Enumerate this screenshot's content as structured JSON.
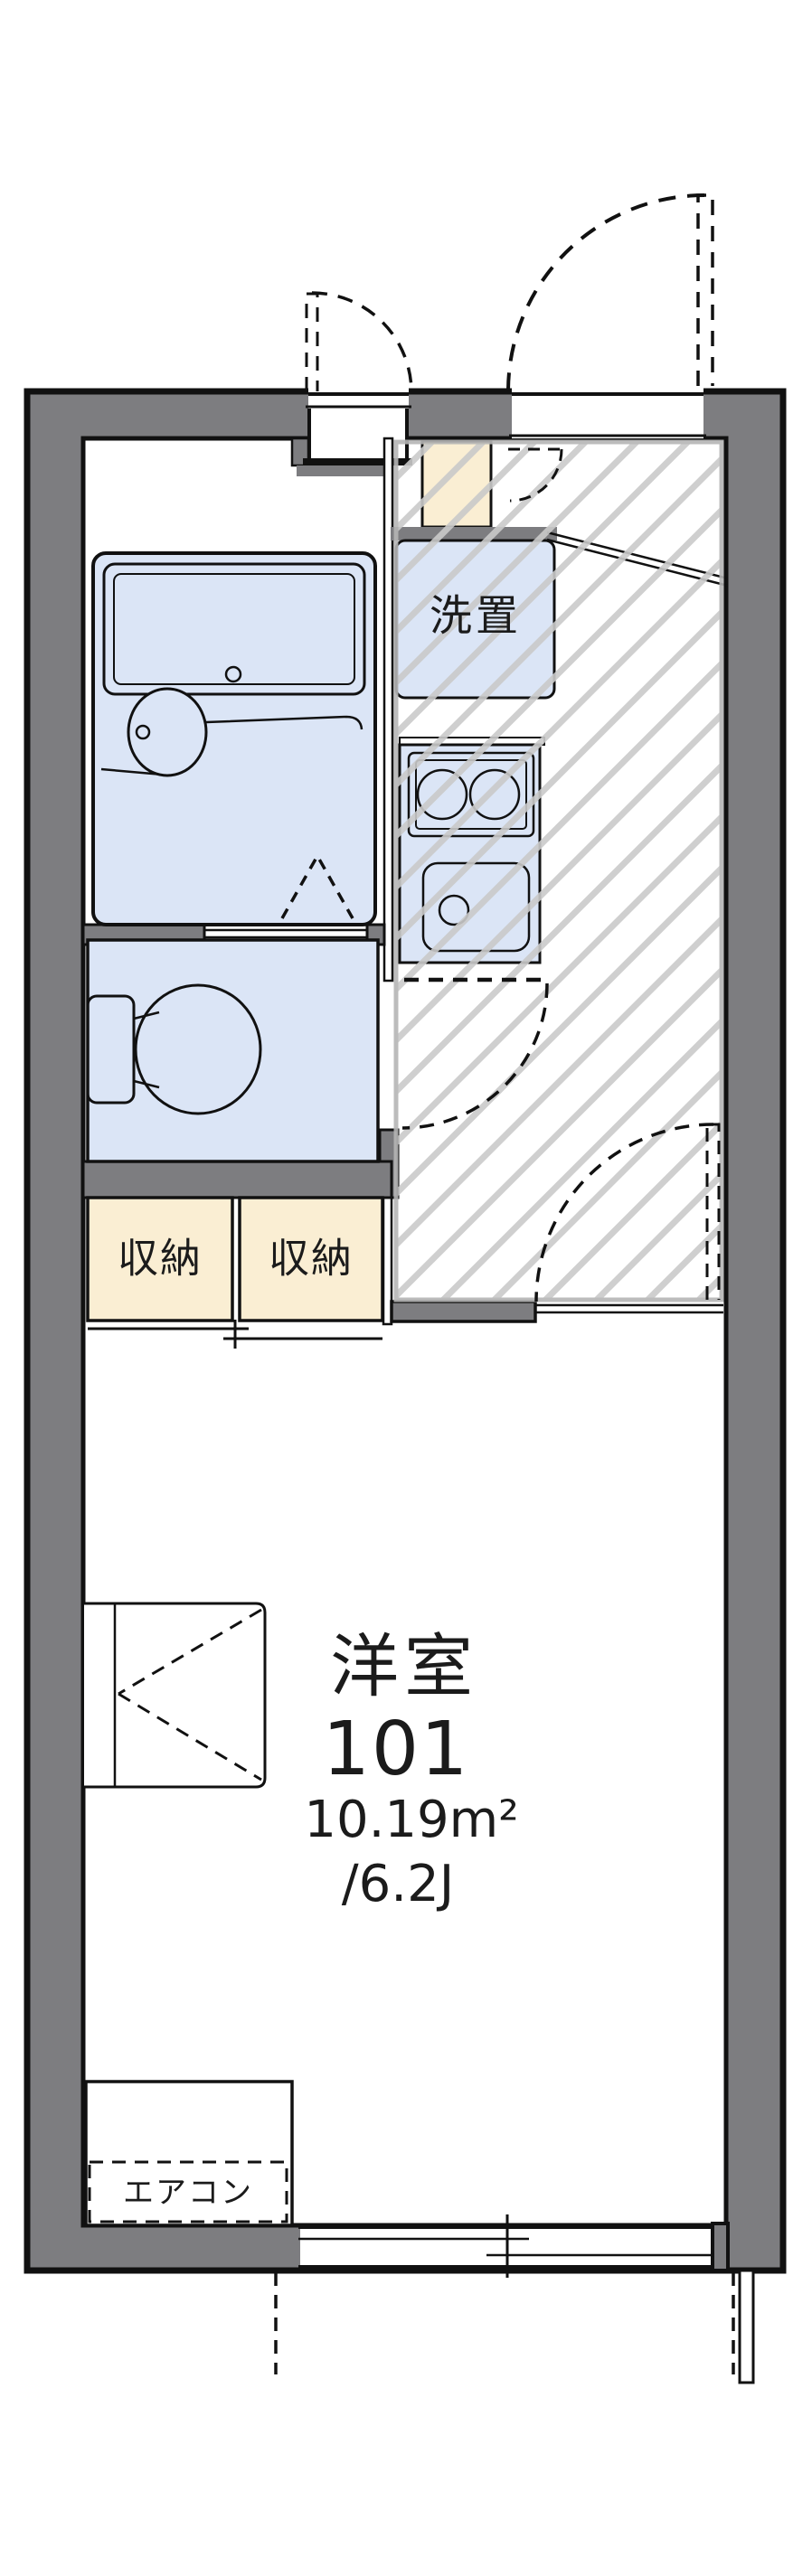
{
  "floor_plan": {
    "unit_label": {
      "room_type": "洋室",
      "room_number": "101",
      "area_sqm": "10.19m²",
      "area_tatami": "/6.2J"
    },
    "labels": {
      "washer_space": "洗置",
      "storage_left": "収納",
      "storage_right": "収納",
      "air_conditioner": "エアコン"
    },
    "colors": {
      "wall_gray": "#7d7d80",
      "fixture_blue": "#dbe5f6",
      "storage_beige": "#faeed3",
      "hatch_line": "#cacaca",
      "hatch_border": "#b5b5b5",
      "line_black": "#111111"
    }
  }
}
